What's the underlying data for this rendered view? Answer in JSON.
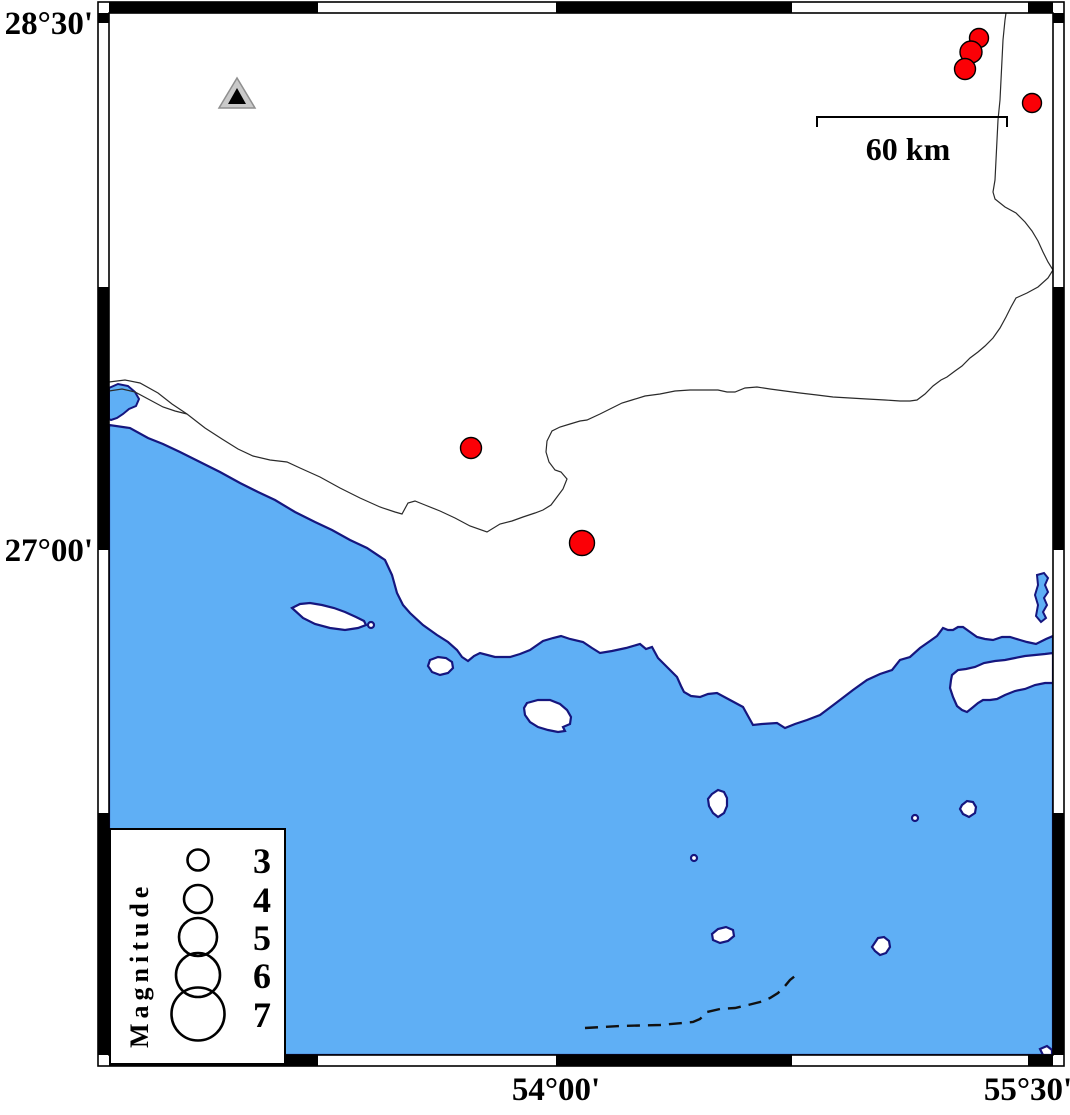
{
  "map_frame": {
    "latitude_labels": [
      {
        "text": "28°30'",
        "tick_y_px": 23
      },
      {
        "text": "27°00'",
        "tick_y_px": 550
      }
    ],
    "longitude_labels": [
      {
        "text": "54°00'",
        "tick_x_px": 556
      },
      {
        "text": "55°30'",
        "tick_x_px": 1028
      }
    ],
    "tick_interval": "45 minutes, alternating black/white fancy frame"
  },
  "scale_bar": {
    "label": "60 km",
    "length_km": 60,
    "x1_px": 817,
    "x2_px": 1007,
    "y_px": 117
  },
  "legend": {
    "title": "Magnitude",
    "circle_cx_px": 198,
    "number_x_px": 262,
    "entries": [
      {
        "label": "3",
        "magnitude": 3,
        "radius_px": 10.5,
        "cy_px": 860
      },
      {
        "label": "4",
        "magnitude": 4,
        "radius_px": 14,
        "cy_px": 899
      },
      {
        "label": "5",
        "magnitude": 5,
        "radius_px": 19,
        "cy_px": 937
      },
      {
        "label": "6",
        "magnitude": 6,
        "radius_px": 22,
        "cy_px": 975
      },
      {
        "label": "7",
        "magnitude": 7,
        "radius_px": 26.5,
        "cy_px": 1014
      }
    ]
  },
  "station": {
    "symbol": "gray triangle with black center",
    "x_px": 237,
    "y_px": 97
  },
  "earthquakes": [
    {
      "x_px": 979,
      "y_px": 38,
      "radius_px": 9.5,
      "approx_magnitude": 3.0
    },
    {
      "x_px": 971,
      "y_px": 52,
      "radius_px": 11,
      "approx_magnitude": 3.1
    },
    {
      "x_px": 965,
      "y_px": 69,
      "radius_px": 10.5,
      "approx_magnitude": 3.0
    },
    {
      "x_px": 1032,
      "y_px": 103,
      "radius_px": 9.5,
      "approx_magnitude": 3.0
    },
    {
      "x_px": 471,
      "y_px": 448,
      "radius_px": 10.5,
      "approx_magnitude": 3.0
    },
    {
      "x_px": 582,
      "y_px": 543,
      "radius_px": 12.5,
      "approx_magnitude": 3.4
    }
  ],
  "colors": {
    "sea": "#5FAFF5",
    "coastline": "#16167e",
    "land": "#ffffff",
    "epicenter": "#fb0006",
    "frame": "#000000",
    "station_gray": "#c9c9c9"
  }
}
